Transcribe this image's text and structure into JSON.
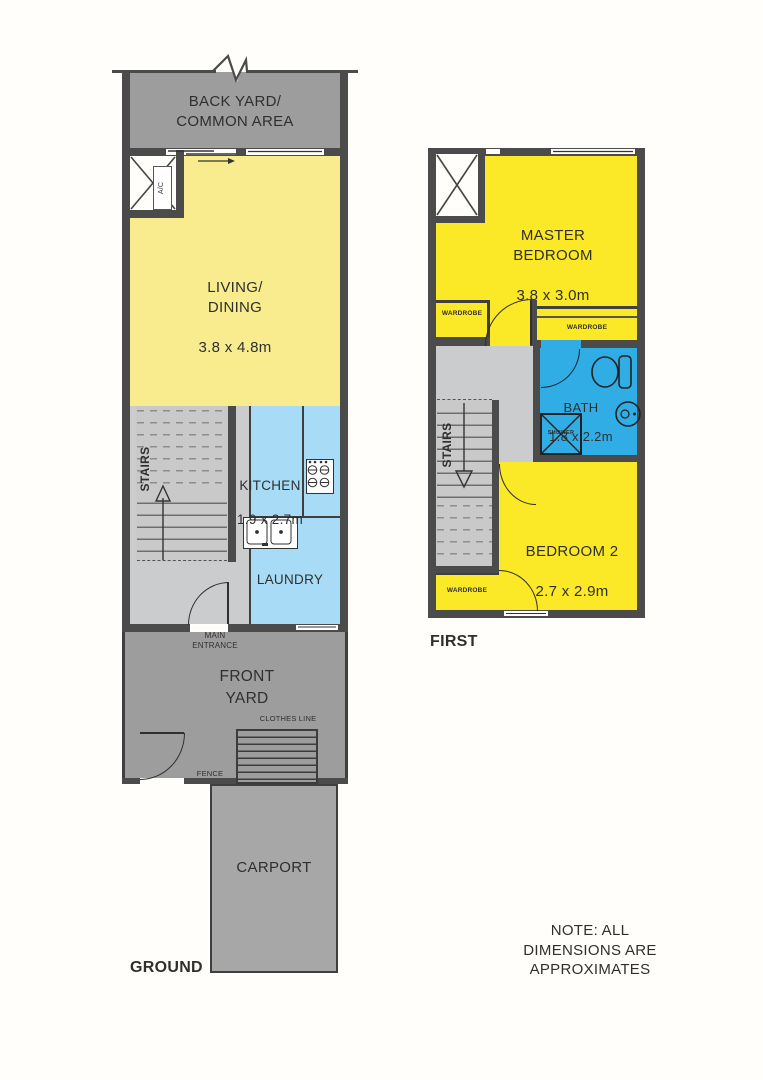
{
  "ground": {
    "floor_label": "GROUND",
    "back_yard_label": "BACK YARD/\nCOMMON AREA",
    "ac_label": "A/C",
    "living_name": "LIVING/\nDINING",
    "living_dims": "3.8 x 4.8m",
    "stairs_label": "STAIRS",
    "kitchen_name": "KITCHEN",
    "kitchen_dims": "1.9 x 2.7m",
    "laundry_label": "LAUNDRY",
    "main_entrance_label": "MAIN\nENTRANCE",
    "front_yard_label": "FRONT\nYARD",
    "clothes_line_label": "CLOTHES LINE",
    "fence_label": "FENCE",
    "carport_label": "CARPORT"
  },
  "first": {
    "floor_label": "FIRST",
    "master_name": "MASTER\nBEDROOM",
    "master_dims": "3.8 x 3.0m",
    "wardrobe_left_label": "WARDROBE",
    "wardrobe_right_label": "WARDROBE",
    "wardrobe_bottom_label": "WARDROBE",
    "bath_name": "BATH",
    "bath_dims": "1.8 x 2.2m",
    "shower_label": "SHOWER",
    "stairs_label": "STAIRS",
    "bedroom2_name": "BEDROOM 2",
    "bedroom2_dims": "2.7 x 2.9m"
  },
  "note_label": "NOTE: ALL\nDIMENSIONS ARE\nAPPROXIMATES",
  "colors": {
    "wall": "#4b4b4b",
    "yard": "#9d9d9d",
    "carport": "#a7a7a7",
    "pale_yellow": "#f8ec8e",
    "vivid_yellow": "#fbe827",
    "light_blue": "#a8dcf6",
    "bath_blue": "#30ade4",
    "stair_gray": "#c9c9c9",
    "hall_gray": "#cbcccd",
    "line": "#2f2f2f"
  }
}
